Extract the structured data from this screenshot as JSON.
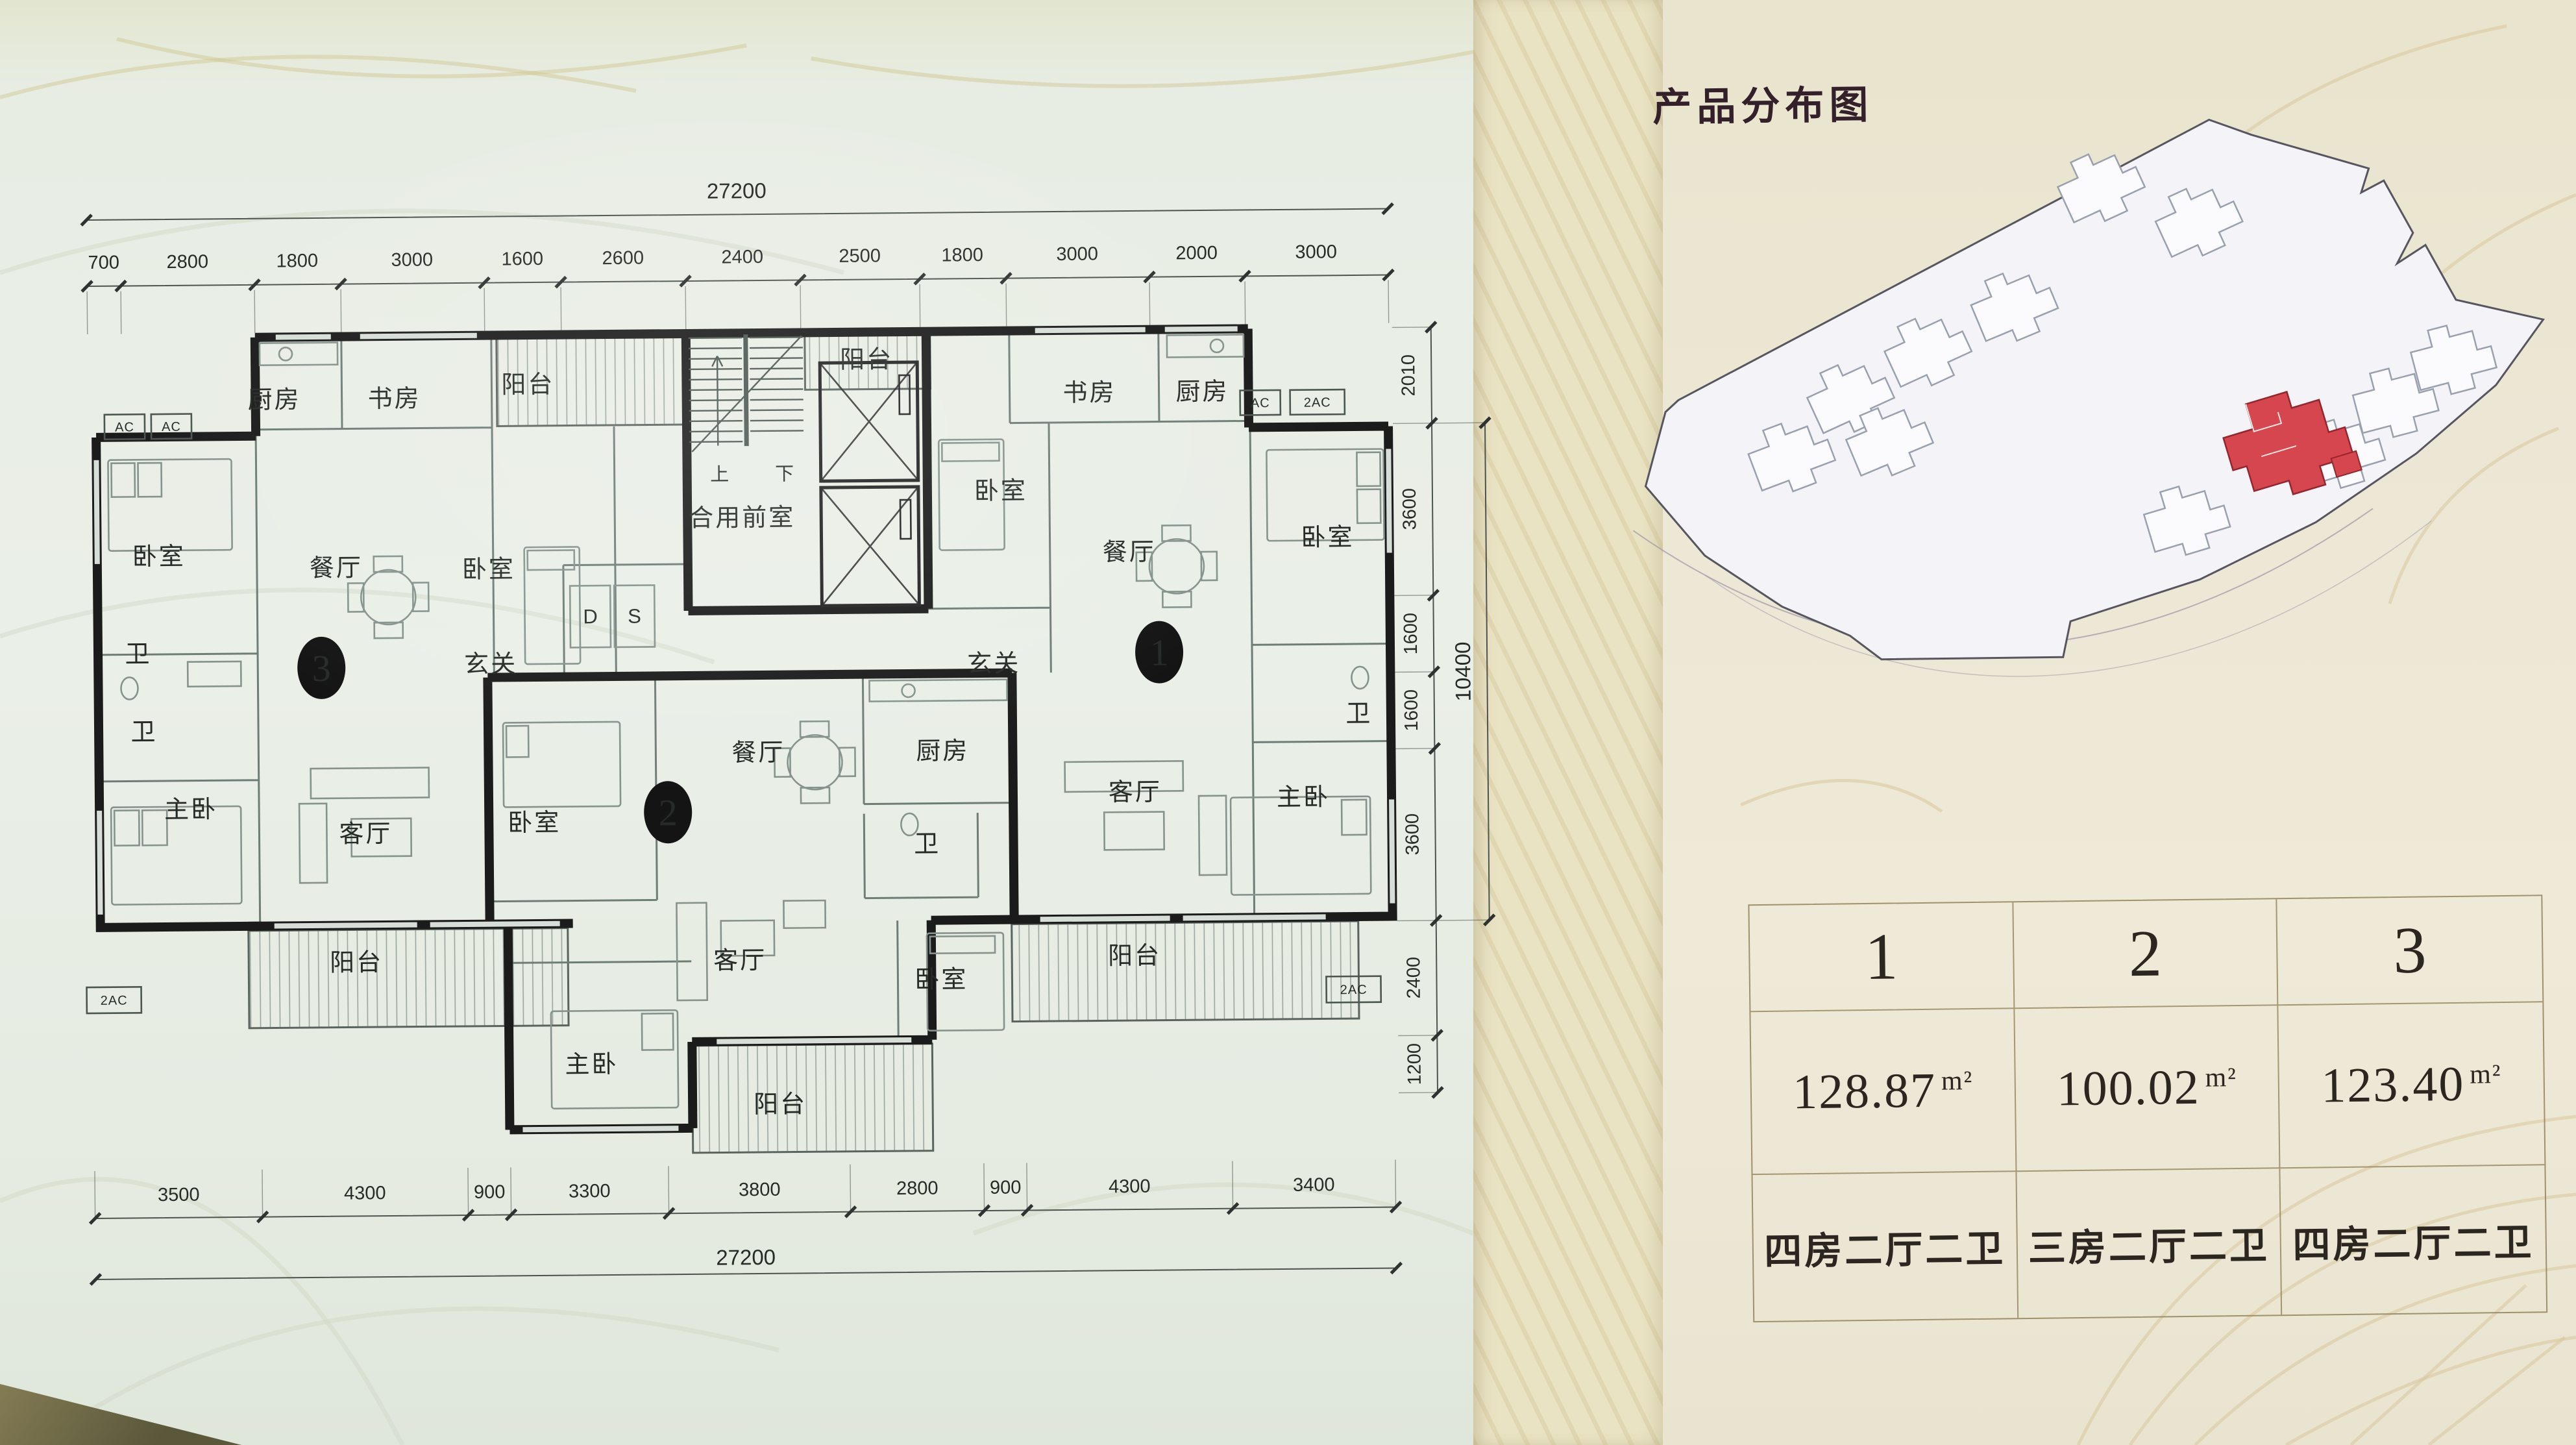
{
  "title": "产品分布图",
  "colors": {
    "accent_red": "#d5464e",
    "wall_ink": "#1b1b1b",
    "dim_text": "#5b625e",
    "board_left": "#e8ede4",
    "board_right": "#ece7d4",
    "table_line": "#9c8c60"
  },
  "plan": {
    "dims": {
      "top_total": "27200",
      "top": [
        "700",
        "2800",
        "1800",
        "3000",
        "1600",
        "2600",
        "2400",
        "2500",
        "1800",
        "3000",
        "2000",
        "3000"
      ],
      "bottom": [
        "3500",
        "4300",
        "900",
        "3300",
        "3800",
        "2800",
        "900",
        "4300",
        "3400"
      ],
      "bottom_total": "27200",
      "right": [
        "2010",
        "3600",
        "1600",
        "1600",
        "3600",
        "2400",
        "1200"
      ],
      "right_total": "10400"
    },
    "rooms": {
      "kitchen": "厨房",
      "study": "书房",
      "balcony": "阳台",
      "bedroom": "卧室",
      "dining": "餐厅",
      "entry": "玄关",
      "bath": "卫",
      "master": "主卧",
      "living": "客厅",
      "lobby": "合用前室",
      "up": "上",
      "down": "下",
      "closet_d": "D",
      "closet_s": "S",
      "ac": "AC",
      "ac2": "2AC"
    },
    "units": [
      "1",
      "2",
      "3"
    ]
  },
  "table": {
    "columns": [
      {
        "no": "1",
        "area": "128.87",
        "unit": "m²",
        "layout": "四房二厅二卫"
      },
      {
        "no": "2",
        "area": "100.02",
        "unit": "m²",
        "layout": "三房二厅二卫"
      },
      {
        "no": "3",
        "area": "123.40",
        "unit": "m²",
        "layout": "四房二厅二卫"
      }
    ]
  }
}
